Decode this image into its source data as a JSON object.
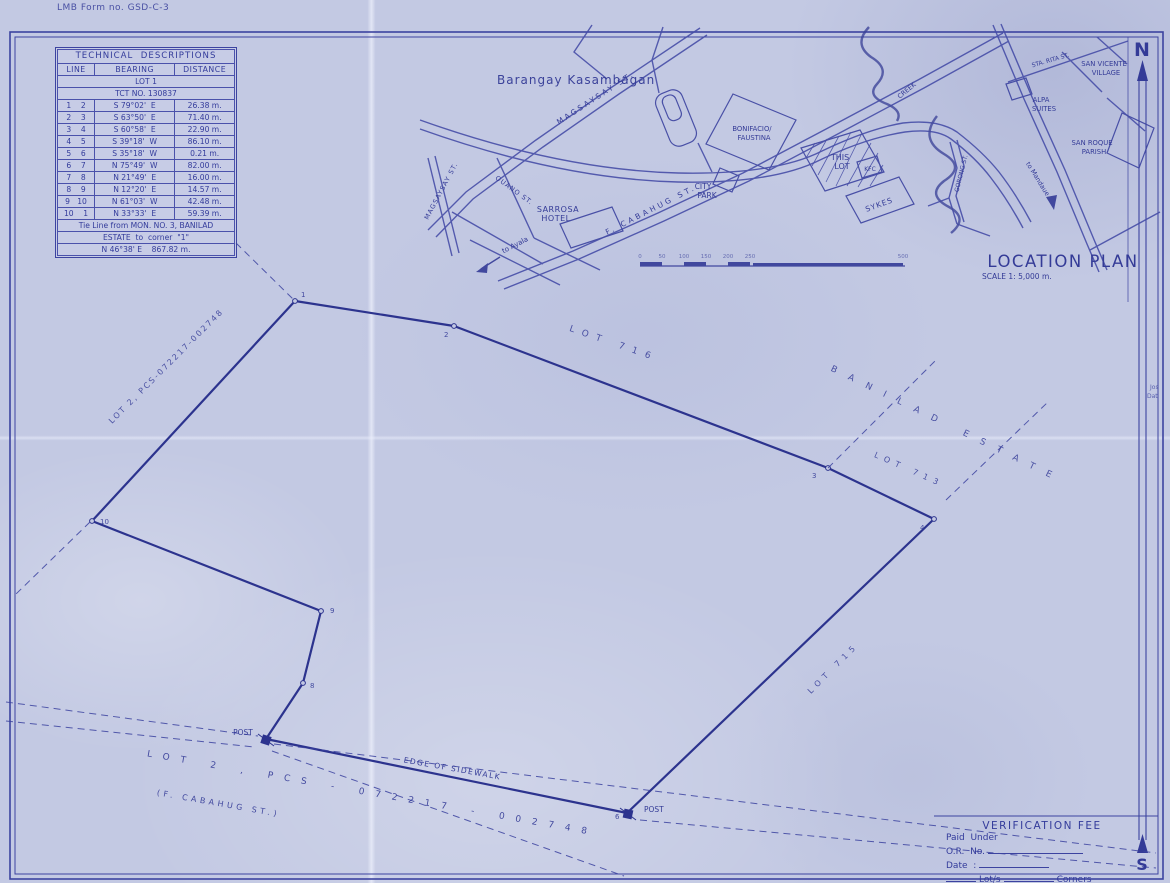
{
  "colors": {
    "paper": "#c3c9e3",
    "ink": "#3a41a0"
  },
  "form_no": "LMB Form no. GSD-C-3",
  "tech_table": {
    "title": "TECHNICAL  DESCRIPTIONS",
    "col_line": "LINE",
    "col_bearing": "BEARING",
    "col_distance": "DISTANCE",
    "lot_label": "LOT 1",
    "tct_label": "TCT NO. 130837",
    "rows": [
      {
        "line": "1    2",
        "bearing": "S 79°02'  E",
        "distance": "26.38 m."
      },
      {
        "line": "2    3",
        "bearing": "S 63°50'  E",
        "distance": "71.40 m."
      },
      {
        "line": "3    4",
        "bearing": "S 60°58'  E",
        "distance": "22.90 m."
      },
      {
        "line": "4    5",
        "bearing": "S 39°18'  W",
        "distance": "86.10 m."
      },
      {
        "line": "5    6",
        "bearing": "S 35°18'  W",
        "distance": "0.21 m."
      },
      {
        "line": "6    7",
        "bearing": "N 75°49'  W",
        "distance": "82.00 m."
      },
      {
        "line": "7    8",
        "bearing": "N 21°49'  E",
        "distance": "16.00 m."
      },
      {
        "line": "8    9",
        "bearing": "N 12°20'  E",
        "distance": "14.57 m."
      },
      {
        "line": "9   10",
        "bearing": "N 61°03'  W",
        "distance": "42.48 m."
      },
      {
        "line": "10    1",
        "bearing": "N 33°33'  E",
        "distance": "59.39 m."
      }
    ],
    "tie_note_1": "Tie Line from MON. NO. 3, BANILAD",
    "tie_note_2": "ESTATE  to  corner  \"1\"",
    "tie_value": "N 46°38' E    867.82 m."
  },
  "location_plan": {
    "title": "LOCATION  PLAN",
    "scale_label": "SCALE 1:  5,000 m.",
    "barangay": "Barangay Kasambagan",
    "streets": {
      "magsaysay": "MAGSAYSAY  ST.",
      "magsaysay_left": "MAGSAYSAY ST.",
      "ouano": "OUANO ST.",
      "cabahug": "F. CABAHUG ST.",
      "gorong": "GORONG ST.",
      "sta_rita": "STA. RITA ST.",
      "to_ayala": "to Ayala",
      "to_mandaue": "to Mandaue",
      "creek": "CREEK"
    },
    "places": {
      "sarrosa_1": "SARROSA",
      "sarrosa_2": "HOTEL",
      "city_1": "CITY",
      "city_2": "PARK",
      "bonifacio_1": "BONIFACIO/",
      "bonifacio_2": "FAUSTINA",
      "this_1": "THIS",
      "this_2": "LOT",
      "kfc": "KFC",
      "sykes": "SYKES",
      "alpa_1": "ALPA",
      "alpa_2": "SUITES",
      "san_vicente_1": "SAN VICENTE",
      "san_vicente_2": "VILLAGE",
      "san_roque_1": "SAN ROQUE",
      "san_roque_2": "PARISH"
    },
    "scale_ticks": [
      "0",
      "50",
      "100",
      "150",
      "200",
      "250",
      "500"
    ]
  },
  "survey": {
    "lot_716": "LOT 716",
    "banilad_estate": "BANILAD ESTATE",
    "lot_713": "LOT 713",
    "lot_715": "LOT 715",
    "lot2_upper": "LOT 2, PCS-072217-002748",
    "lot2_lower": "LOT 2 , PCS - 072217 - 002748",
    "cabahug_paren": "(F. CABAHUG ST.)",
    "edge_of_sidewalk": "EDGE OF SIDEWALK",
    "post_left": "POST",
    "post_right": "POST",
    "corners": {
      "c1": "1",
      "c2": "2",
      "c3": "3",
      "c4": "4",
      "c6": "6",
      "c8": "8",
      "c9": "9",
      "c10": "10"
    }
  },
  "verification": {
    "title": "VERIFICATION  FEE",
    "paid_label": "Paid  Under",
    "or_label": "O.R.  No.",
    "date_label": "Date  :",
    "lots_label": "Lot/s",
    "corners_label": "Corners"
  },
  "compass": {
    "north": "N",
    "south": "S"
  },
  "edge_fragments": {
    "f1": "Jos",
    "f2": "Dat"
  }
}
